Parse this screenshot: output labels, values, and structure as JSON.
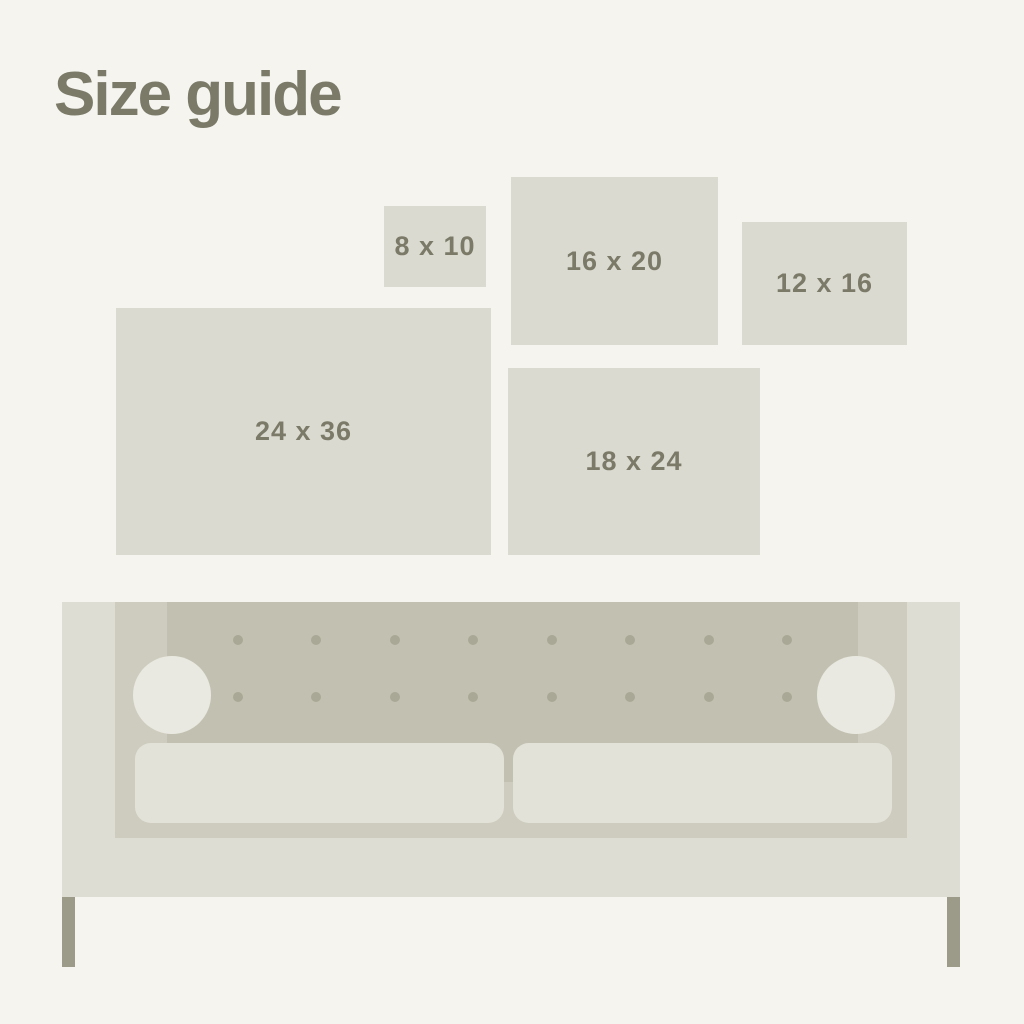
{
  "title": "Size guide",
  "frames": [
    {
      "id": "8x10",
      "label": "8 x 10"
    },
    {
      "id": "16x20",
      "label": "16 x 20"
    },
    {
      "id": "12x16",
      "label": "12 x 16"
    },
    {
      "id": "24x36",
      "label": "24 x 36"
    },
    {
      "id": "18x24",
      "label": "18 x 24"
    }
  ],
  "couch": {
    "tufting_rows": 2,
    "tufting_columns": 8
  },
  "colors": {
    "bg": "#f5f4ef",
    "frame_fill": "#dbdad0",
    "title_text": "#7b7a68",
    "label_text": "#7b7a68",
    "couch_outer": "#deddd3",
    "couch_inner": "#cdccbe",
    "couch_back": "#c2c1b1",
    "button_dot": "#a9a896",
    "bolster": "#eae9e1",
    "cushion": "#e3e2d9",
    "leg": "#9c9b89"
  }
}
